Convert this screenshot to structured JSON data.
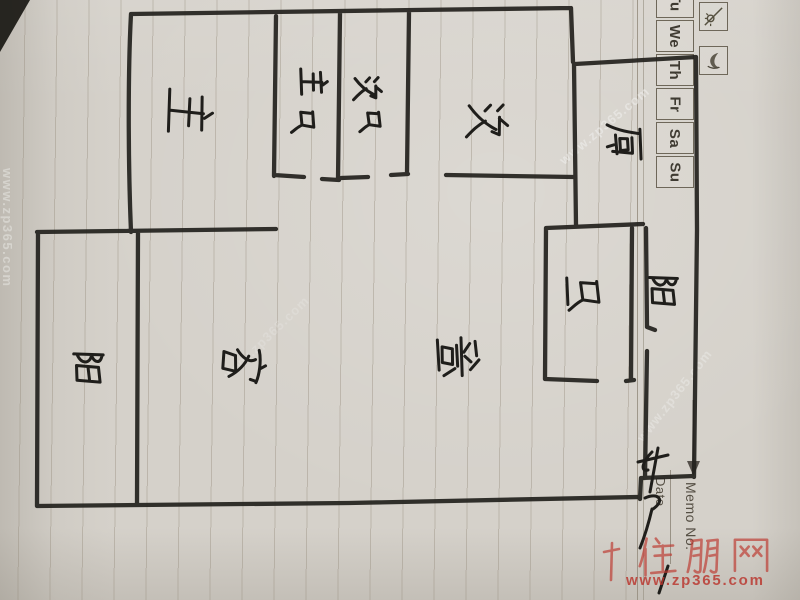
{
  "memo_pad": {
    "weekday_cells": [
      "Tu",
      "We",
      "Th",
      "Fr",
      "Sa",
      "Su"
    ],
    "memo_no_label": "Memo No.",
    "date_label": "Date",
    "day_icon": "day-sun-icon",
    "night_icon": "night-moon-icon"
  },
  "floor_plan": {
    "rooms": [
      {
        "name": "master-bedroom",
        "label": "主"
      },
      {
        "name": "master-bathroom",
        "label": "主卫"
      },
      {
        "name": "second-bathroom",
        "label": "次卫"
      },
      {
        "name": "second-bedroom",
        "label": "次"
      },
      {
        "name": "kitchen",
        "label": "厨"
      },
      {
        "name": "bathroom",
        "label": "卫"
      },
      {
        "name": "living-room",
        "label": "客"
      },
      {
        "name": "dining-room",
        "label": "餐"
      },
      {
        "name": "balcony-left",
        "label": "阳"
      },
      {
        "name": "balcony-right",
        "label": "阳"
      }
    ]
  },
  "watermarks": {
    "brand": "住朋网",
    "site_url": "www.zp365.com",
    "diagonal_text": "www.zp365.com",
    "accent_red": "#c24a41",
    "ink_color": "#23221e",
    "paper_color": "#d5d1ca"
  }
}
